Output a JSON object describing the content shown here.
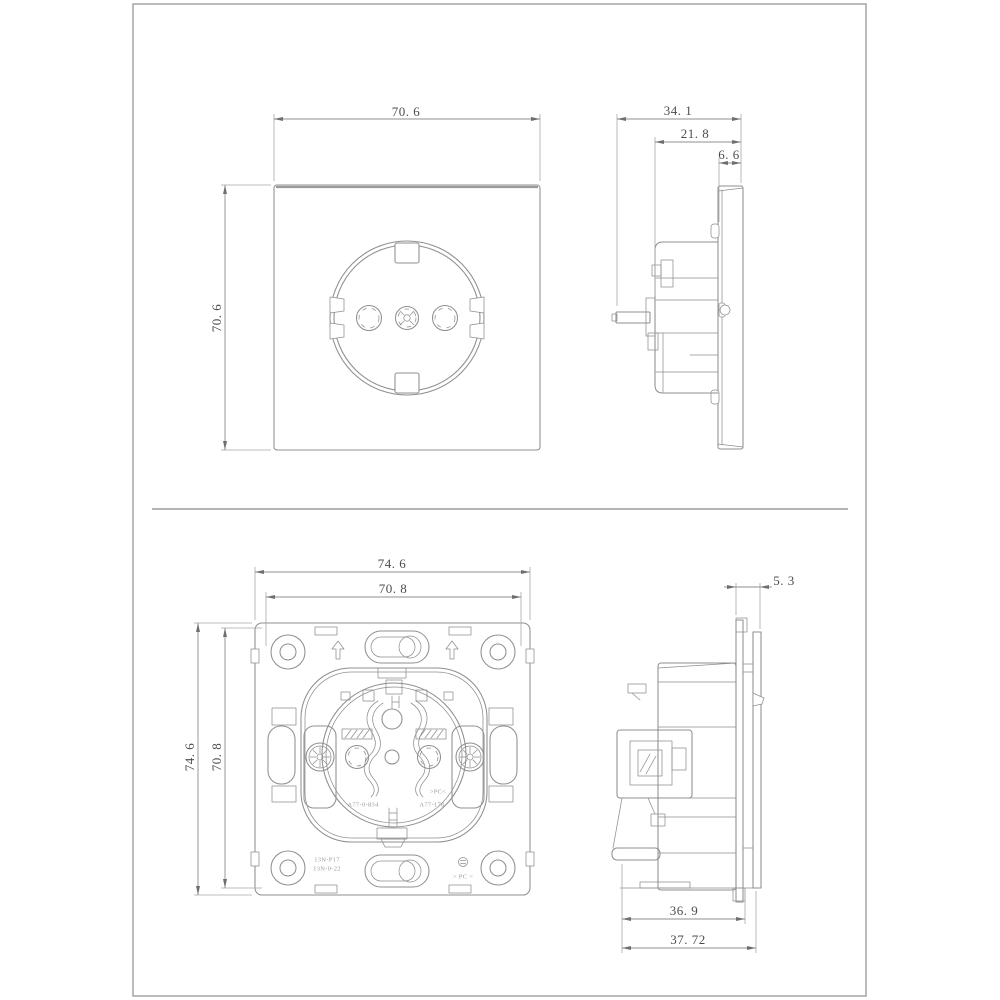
{
  "colors": {
    "background": "#ffffff",
    "page_border": "#ababab",
    "drawing_lines": "#8f8f8f",
    "dimension_text": "#4d4d4d",
    "marking_text": "#9b9b9b"
  },
  "views": {
    "front": {
      "dim_width": "70. 6",
      "dim_height": "70. 6"
    },
    "side_top": {
      "dim_total_depth": "34. 1",
      "dim_body_depth": "21. 8",
      "dim_plate_thickness": "6. 6"
    },
    "back": {
      "dim_outer_width": "74. 6",
      "dim_inner_width": "70. 8",
      "dim_outer_height": "74. 6",
      "dim_inner_height": "70. 8",
      "markings": {
        "part_left": "A77-0-834",
        "material_inner": ">PC<",
        "part_right": "A77-178",
        "code_line1": "13N-P17",
        "code_line2": "13N-0-22",
        "material_bottom": "> PC <"
      }
    },
    "side_bottom": {
      "dim_rear_depth": "5. 3",
      "dim_depth_to_claw": "36. 9",
      "dim_total_depth": "37. 72"
    }
  }
}
